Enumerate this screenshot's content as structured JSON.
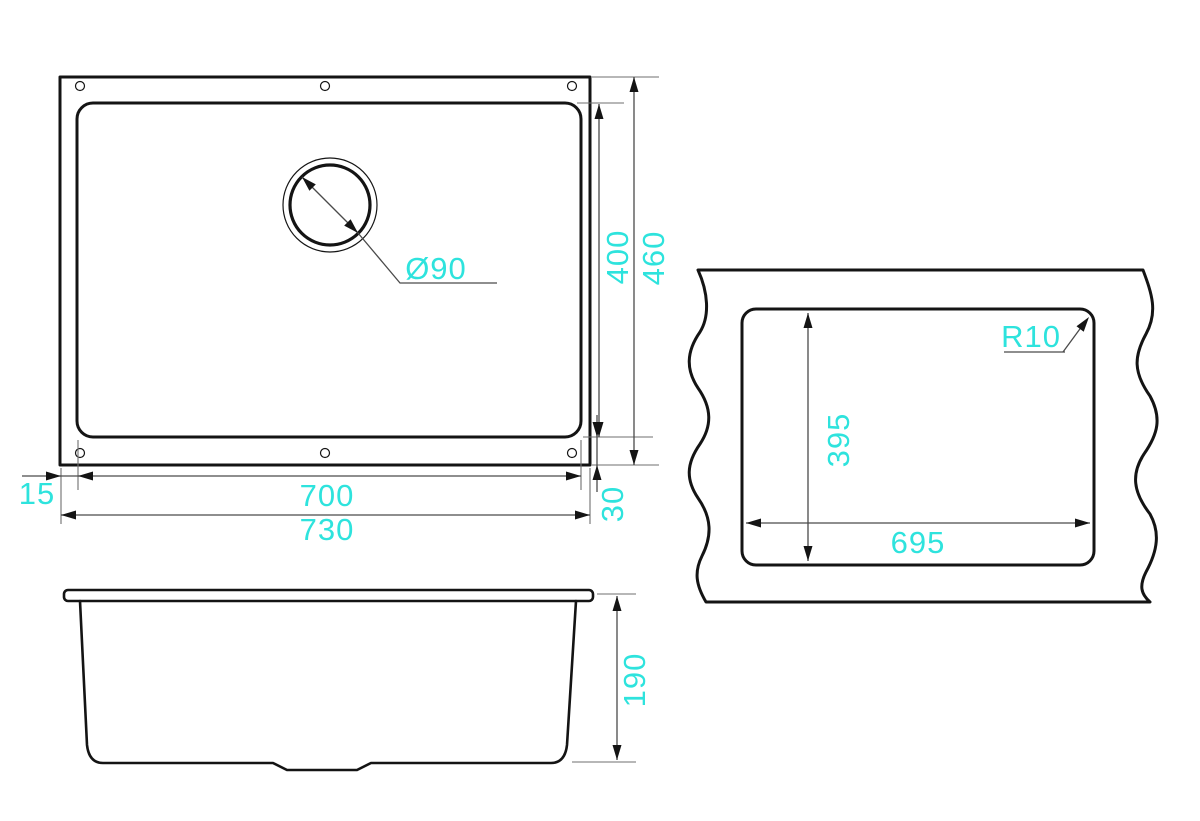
{
  "title": "Undermount sink dimensional drawing",
  "colors": {
    "dimension_text": "#2ee3dd",
    "outline": "#141414",
    "dimension_line": "#4a4a4a"
  },
  "views": {
    "top": {
      "label": "sink top view",
      "dims": {
        "drain_diameter": "Ø90",
        "bowl_depth": "400",
        "overall_depth": "460",
        "flange_left": "15",
        "bowl_width": "700",
        "overall_width": "730",
        "flange_bottom": "30"
      }
    },
    "cutout": {
      "label": "countertop cutout view",
      "dims": {
        "corner_radius": "R10",
        "cutout_depth": "395",
        "cutout_width": "695"
      }
    },
    "side": {
      "label": "sink side view",
      "dims": {
        "bowl_height": "190"
      }
    }
  }
}
